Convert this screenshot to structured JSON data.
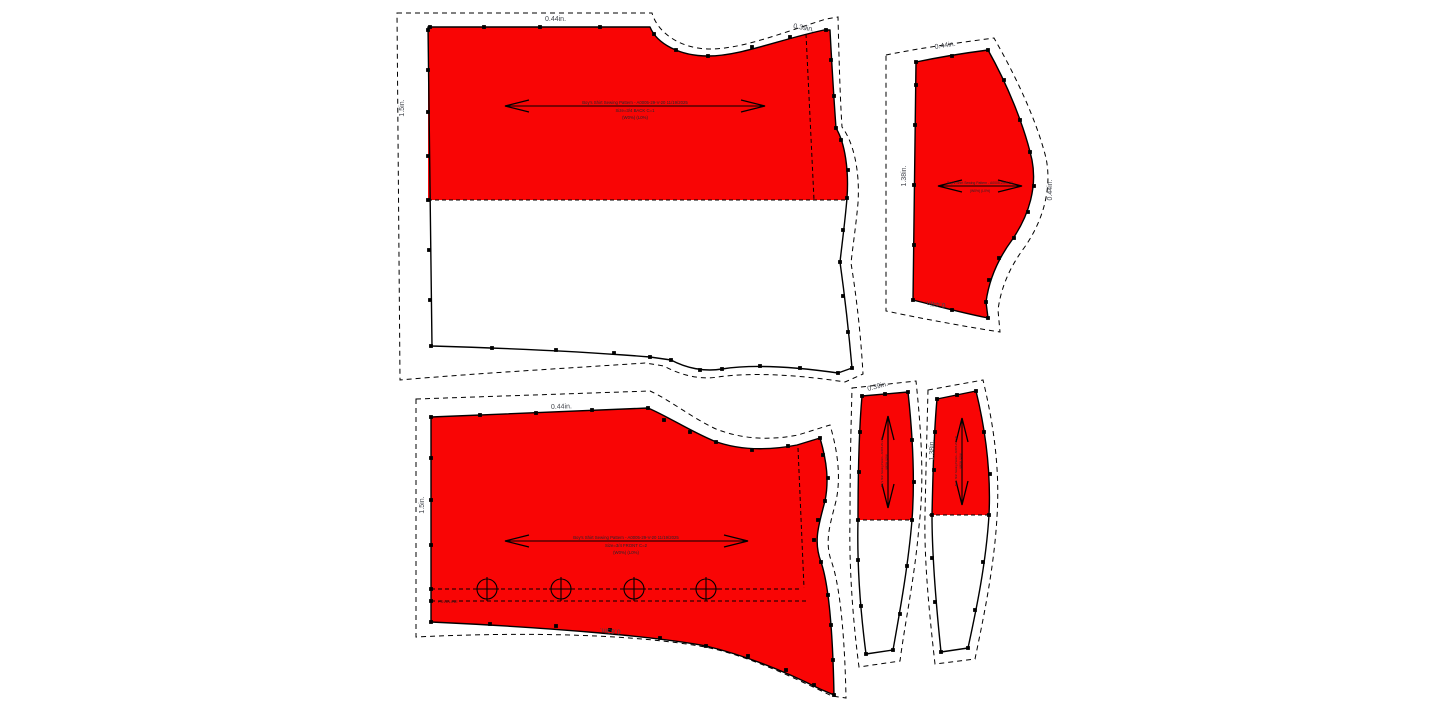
{
  "colors": {
    "background": "#ffffff",
    "piece_fill": "#f90505",
    "outline": "#000000",
    "dim_label": "#43464d",
    "title_label": "#23272e"
  },
  "pieces": {
    "back": {
      "title_line1": "Boy's Shirt Sewing Pattern - A0005-29-V-20  11/19/2025",
      "title_line2": "Size=3/4 BACK C=1",
      "title_line3": "(W0%) (L0%)",
      "dim_top": "0.44in.",
      "dim_shoulder": "0.39in.",
      "dim_left": "1.5in."
    },
    "front": {
      "title_line1": "Boy's Shirt Sewing Pattern - A0005-29-V-20  11/19/2025",
      "title_line2": "Size=3/4 FRONT C=2",
      "title_line3": "(W0%) (L0%)",
      "dim_top": "0.44in.",
      "dim_left": "1.5in.",
      "dim_bottom": "0.63in.",
      "foldline": "FOLDLINE"
    },
    "sleeve": {
      "title_line1": "Boy's Shirt Sewing Pattern - A0005-29-V-20",
      "title_line2": "(W0%) (L0%)",
      "dim_top": "0.44in.",
      "dim_left": "1.38in.",
      "dim_right": "0.44in.",
      "dim_bottom": "0.44in."
    },
    "band_a": {
      "title_line1": "Boy's Shirt Sewing Pattern - A0005-29-V-20",
      "title_line2": "(W0%) (L0%)",
      "dim_top": "0.39in."
    },
    "band_b": {
      "title_line1": "Boy's Shirt Sewing Pattern - A0005-29-V-20",
      "title_line2": "(W0%) (L0%)",
      "dim_left": "1.38in."
    }
  }
}
